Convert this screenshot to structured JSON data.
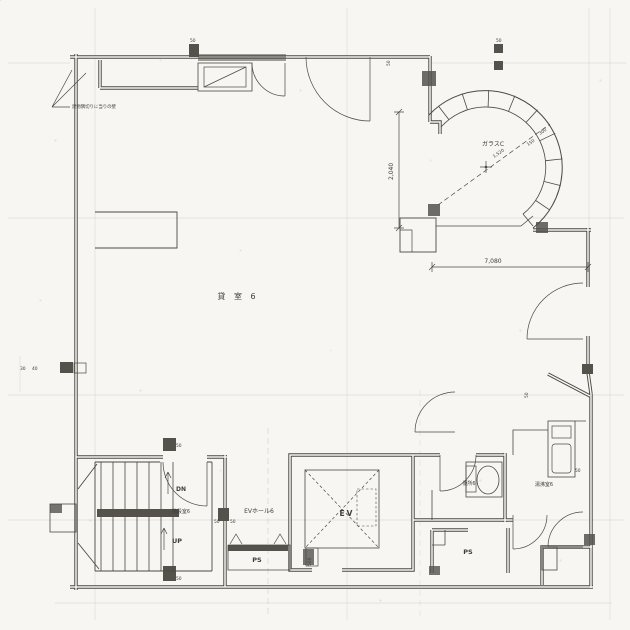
{
  "drawing": {
    "note": "建物隅切りに当りの壁",
    "glass_label": "ガラスC",
    "rooms": {
      "main": "貸 室 6",
      "stair": "階段室6",
      "ev_hall": "EVホール6",
      "elevator": "EV",
      "ps_left": "PS",
      "ps_right": "PS",
      "toilet": "便所6",
      "kitchenette": "湯沸室6"
    },
    "stairs": {
      "up": "UP",
      "down": "DN"
    },
    "dimensions": {
      "bay_height": "2,040",
      "bay_width": "7,080",
      "ev_door": "500",
      "bay_radius": "1,520"
    },
    "ticks": [
      "50",
      "50",
      "50",
      "50",
      "50",
      "50",
      "30",
      "40",
      "50",
      "50",
      "150",
      "300",
      "50"
    ],
    "colors": {
      "paper": "#f7f6f2",
      "ink": "#4b4944",
      "faint": "#c9c6bd"
    }
  }
}
